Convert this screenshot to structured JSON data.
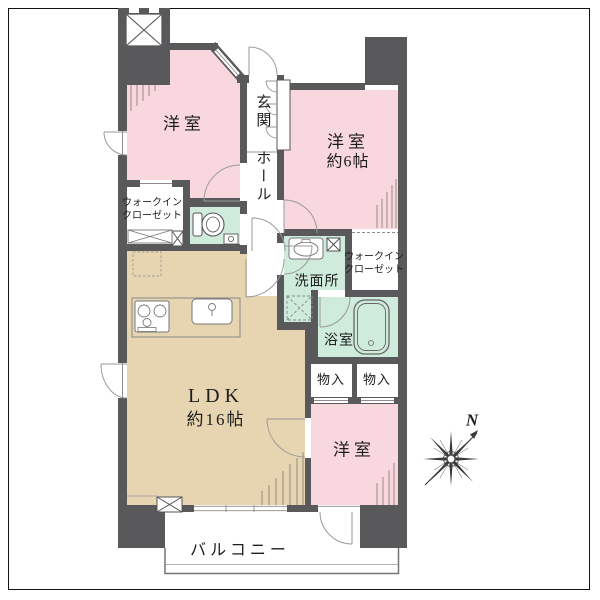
{
  "plan": {
    "rooms": {
      "bedroom_top_left": {
        "label": "洋室"
      },
      "bedroom_top_right": {
        "label": "洋室",
        "size": "約6帖"
      },
      "bedroom_bottom": {
        "label": "洋室"
      },
      "entrance": {
        "label": "玄関"
      },
      "hallway": {
        "label": "ホール"
      },
      "walk_in_closet_left": {
        "line1": "ウォークイン",
        "line2": "クローゼット"
      },
      "walk_in_closet_right": {
        "line1": "ウォークイン",
        "line2": "クローゼット"
      },
      "washroom": {
        "label": "洗面所"
      },
      "bathroom": {
        "label": "浴室"
      },
      "storage_left": {
        "label": "物入"
      },
      "storage_right": {
        "label": "物入"
      },
      "ldk": {
        "label": "LDK",
        "size": "約16帖"
      },
      "balcony": {
        "label": "バルコニー"
      }
    },
    "compass": {
      "label": "N"
    },
    "colors": {
      "wall": "#59595c",
      "bedroom_fill": "#f8d7de",
      "wet_area_fill": "#cfebdb",
      "ldk_fill": "#e6d5b0",
      "thin_line": "#8c8c8c"
    },
    "icons": [
      "compass-icon",
      "toilet-icon",
      "bathtub-icon",
      "kitchen-stove-icon",
      "kitchen-sink-icon",
      "washbasin-icon",
      "elevator-x-icon",
      "pipe-space-x-icon",
      "closet-shelf-icon",
      "door-swing-icon"
    ]
  }
}
